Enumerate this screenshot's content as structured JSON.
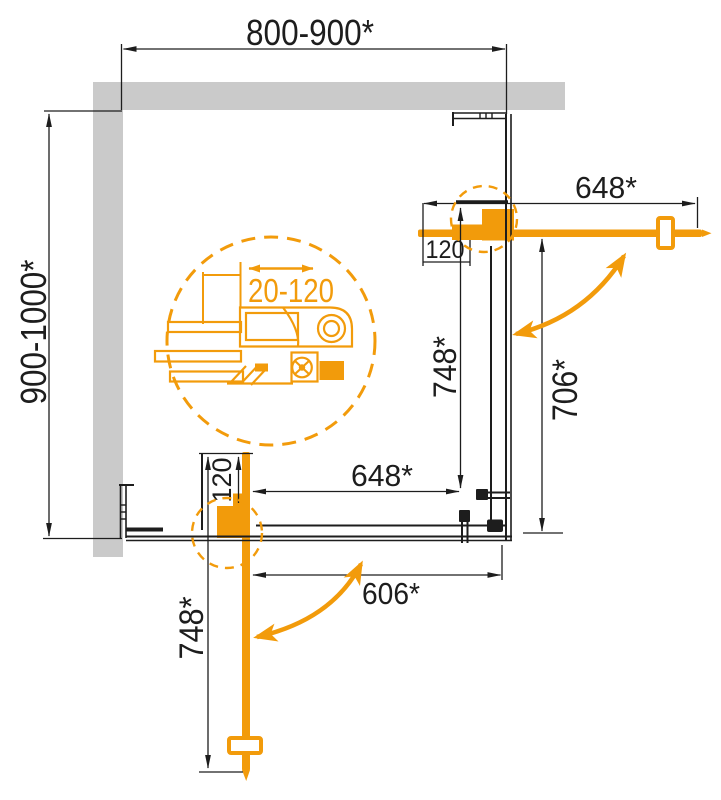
{
  "drawing_labels": {
    "overall_width": "800-900*",
    "overall_depth": "900-1000*",
    "right_door_width": "648*",
    "right_hinge_offset": "120",
    "right_door_open_length": "748*",
    "right_opening_clearance": "706*",
    "bottom_panel_width": "648*",
    "bottom_opening_clearance": "606*",
    "bottom_hinge_offset": "120",
    "bottom_door_open_length": "748*",
    "detail_adjustment_range": "20-120"
  },
  "colors": {
    "accent_orange": "#F29B0B",
    "wall_gray": "#CACACA",
    "line_black": "#1D1D1D"
  }
}
